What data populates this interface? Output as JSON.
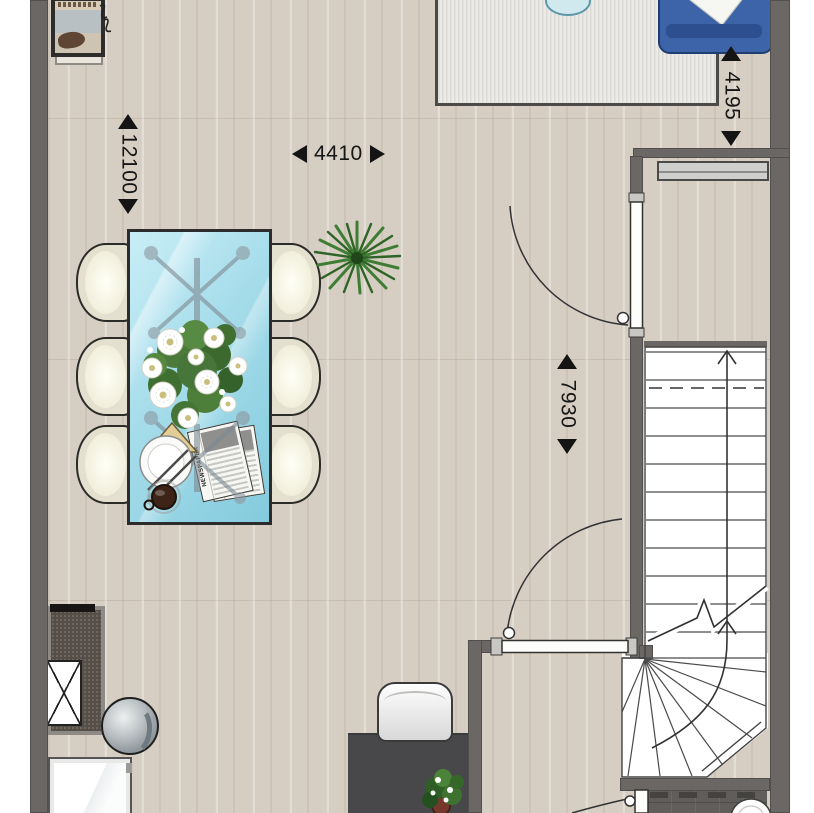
{
  "plan": {
    "type": "floor-plan",
    "floor_material": "wood-planks",
    "dimensions": {
      "room_height": {
        "value": "12100"
      },
      "room_width": {
        "value": "4410"
      },
      "living_depth": {
        "value": "4195"
      },
      "stair_zone": {
        "value": "7930"
      }
    },
    "newspaper_label": "NEWSPAPER",
    "colors": {
      "wall": "#6b6764",
      "floor_base": "#d6cec3",
      "stairs_background": "#ffffff",
      "rug": "#ebeae7",
      "sofa": "#3d63a8",
      "dining_table_glass": "#a5dcea",
      "chair": "#e3e0cf",
      "desk": "#48484a",
      "bathroom_tile": "#605d5a",
      "plant": "#3e7d33",
      "dimension_text": "#161616"
    }
  }
}
